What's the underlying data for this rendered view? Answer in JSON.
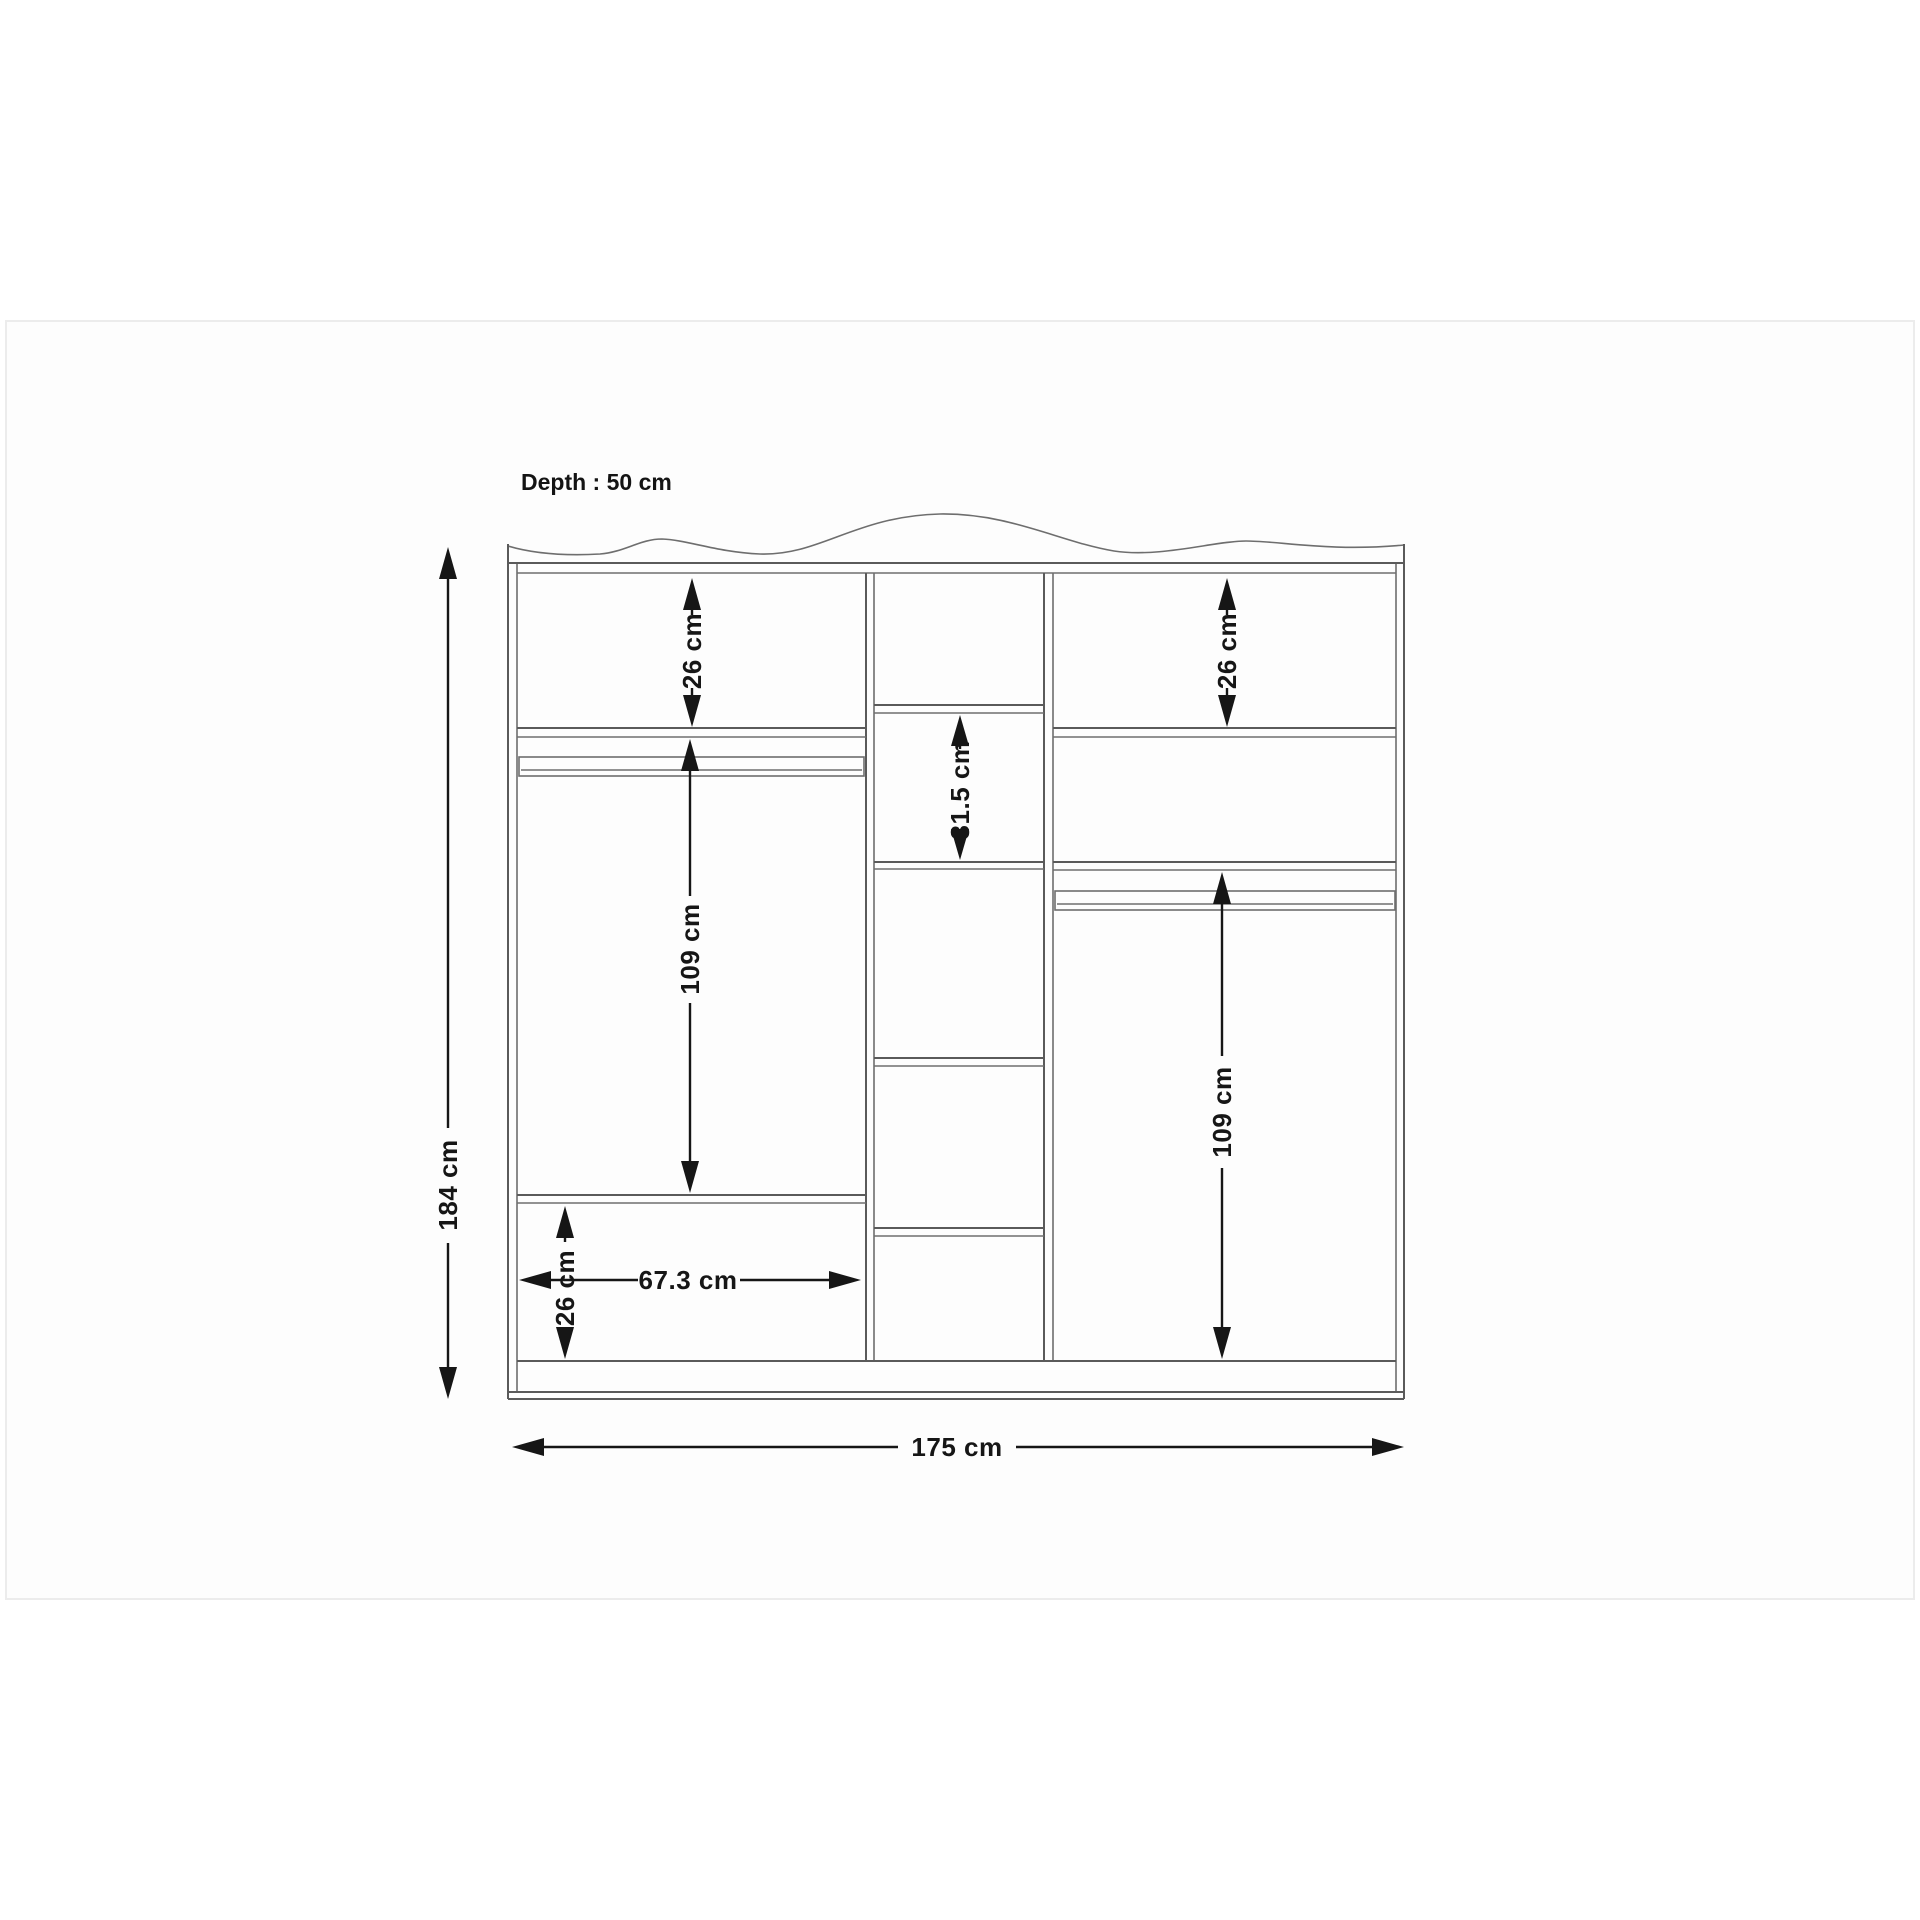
{
  "diagram": {
    "type": "wardrobe-dimension-drawing",
    "depth_label": "Depth : 50 cm",
    "dimensions": {
      "overall_height": "184 cm",
      "overall_width": "175 cm",
      "depth": "50 cm",
      "left_top_section_height": "26 cm",
      "right_top_section_height": "26 cm",
      "center_shelf_section_height": "31.5 cm",
      "left_hanging_section_height": "109 cm",
      "right_hanging_section_height": "109 cm",
      "left_bottom_section_height": "26 cm",
      "left_section_width": "67.3 cm"
    },
    "colors": {
      "background": "#ffffff",
      "drawing_line": "#5a5a5a",
      "dimension_line": "#161616",
      "frame_border": "#ececec"
    }
  }
}
